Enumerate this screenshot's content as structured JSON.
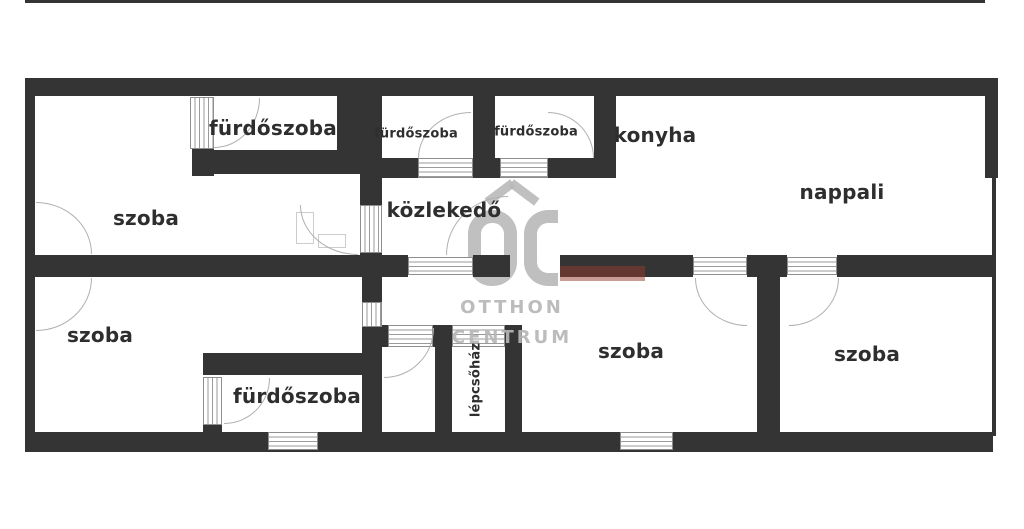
{
  "watermark": {
    "brand_initials": "OC",
    "line1": "OTTHON",
    "line2": "CENTRUM"
  },
  "rooms": {
    "bathroom_top_left": "fürdőszoba",
    "bathroom_mid_left": "fürdőszoba",
    "bathroom_mid_right": "fürdőszoba",
    "kitchen": "konyha",
    "living_room": "nappali",
    "hallway": "közlekedő",
    "room_top_left": "szoba",
    "room_bottom_left": "szoba",
    "room_bottom_middle": "szoba",
    "room_bottom_right": "szoba",
    "bathroom_bottom": "fürdőszoba",
    "stairwell": "lépcsőház"
  },
  "colors": {
    "wall": "#343434",
    "label_text": "#2e2e2e",
    "watermark_gray": "#b7b7b7",
    "symbol_line": "#9a9a9a"
  }
}
